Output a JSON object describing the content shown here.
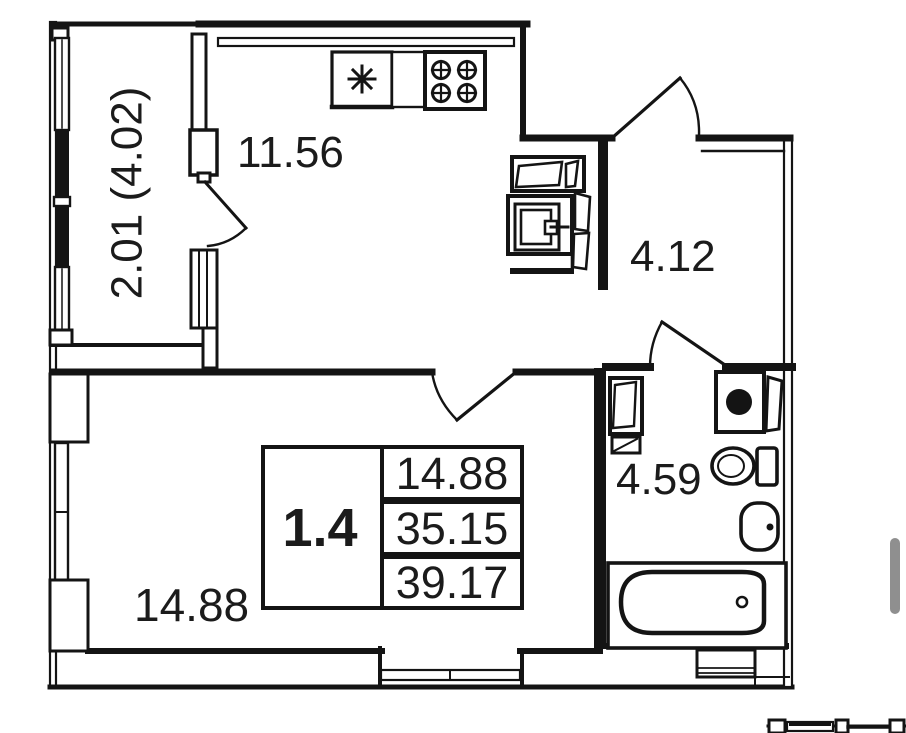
{
  "plan": {
    "balcony_area_label": "2.01 (4.02)",
    "kitchen_area_label": "11.56",
    "hallway_area_label": "4.12",
    "room_area_label": "14.88",
    "bathroom_area_label": "4.59"
  },
  "area_table": {
    "unit_type": "1.4",
    "values": [
      "14.88",
      "35.15",
      "39.17"
    ]
  },
  "fixtures": {
    "kitchen": [
      "sink-icon",
      "stove-icon"
    ],
    "hallway": [
      "counter-icon",
      "washer-top-icon"
    ],
    "bathroom": [
      "water-heater-icon",
      "washing-machine-icon",
      "toilet-icon",
      "wash-basin-icon",
      "bathtub-icon"
    ]
  },
  "colors": {
    "line": "#141414",
    "scrollbar": "#8f8f8f",
    "background": "#ffffff"
  }
}
